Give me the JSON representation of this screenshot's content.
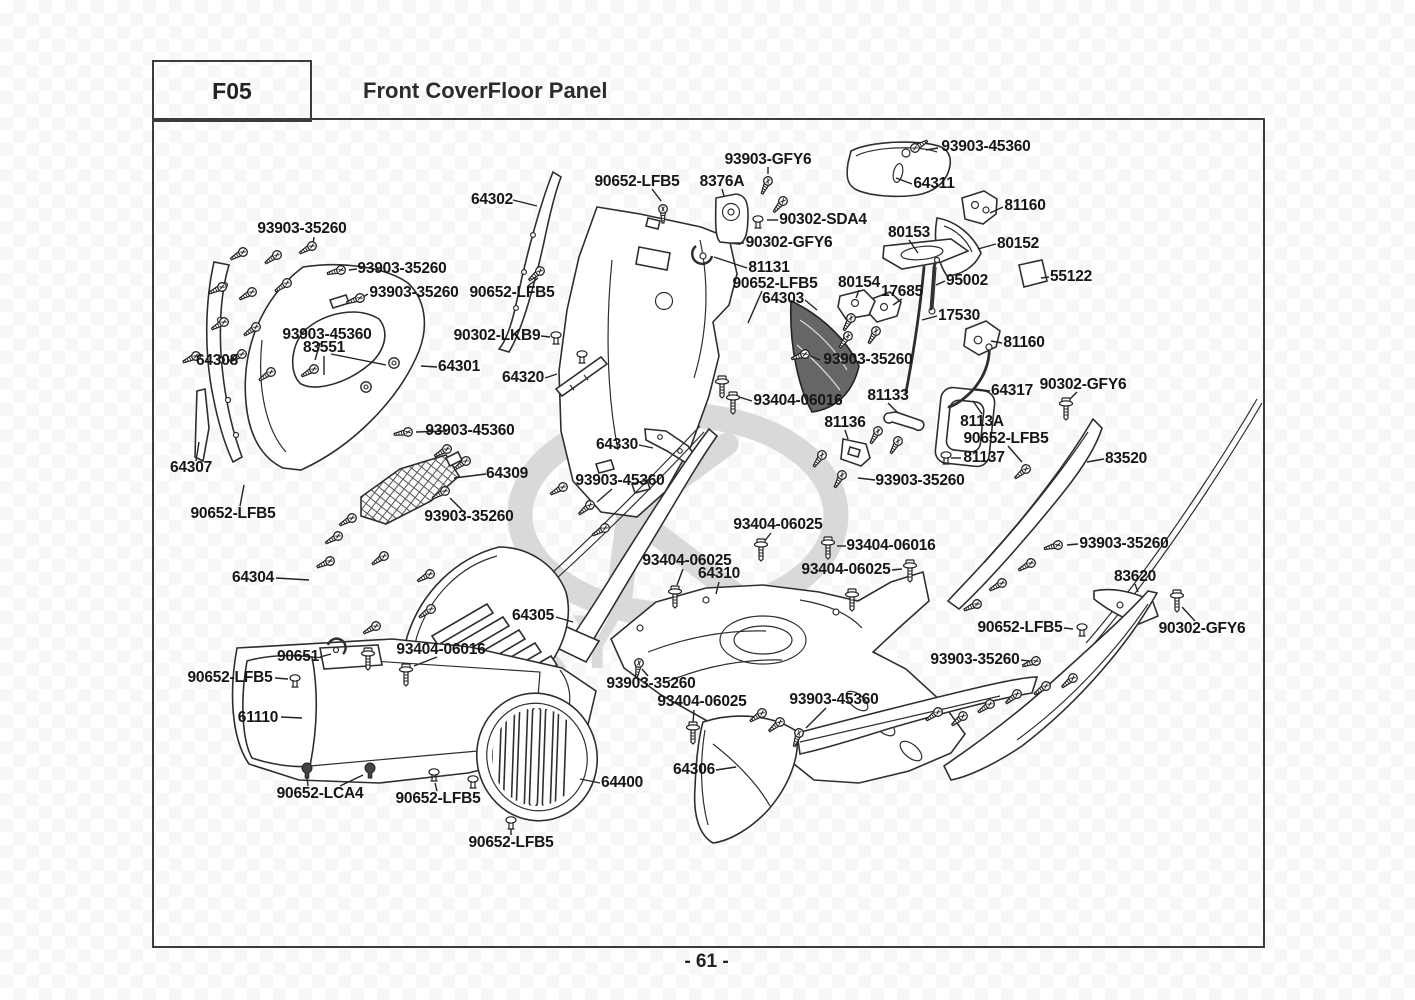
{
  "page": {
    "code": "F05",
    "title": "Front CoverFloor Panel",
    "page_number": "- 61 -",
    "watermark": "KYMCO"
  },
  "diagram": {
    "labels": [
      {
        "t": "93903-45360",
        "x": 986,
        "y": 147
      },
      {
        "t": "93903-GFY6",
        "x": 768,
        "y": 160
      },
      {
        "t": "90652-LFB5",
        "x": 637,
        "y": 182
      },
      {
        "t": "8376A",
        "x": 722,
        "y": 182
      },
      {
        "t": "64302",
        "x": 492,
        "y": 200
      },
      {
        "t": "64311",
        "x": 934,
        "y": 184
      },
      {
        "t": "81160",
        "x": 1025,
        "y": 206
      },
      {
        "t": "90302-SDA4",
        "x": 823,
        "y": 220
      },
      {
        "t": "80153",
        "x": 909,
        "y": 233
      },
      {
        "t": "93903-35260",
        "x": 302,
        "y": 229
      },
      {
        "t": "90302-GFY6",
        "x": 789,
        "y": 243
      },
      {
        "t": "80152",
        "x": 1018,
        "y": 244
      },
      {
        "t": "93903-35260",
        "x": 402,
        "y": 269
      },
      {
        "t": "81131",
        "x": 769,
        "y": 268
      },
      {
        "t": "55122",
        "x": 1071,
        "y": 277
      },
      {
        "t": "95002",
        "x": 967,
        "y": 281
      },
      {
        "t": "90652-LFB5",
        "x": 775,
        "y": 284
      },
      {
        "t": "80154",
        "x": 859,
        "y": 283
      },
      {
        "t": "17685",
        "x": 902,
        "y": 292
      },
      {
        "t": "93903-35260",
        "x": 414,
        "y": 293
      },
      {
        "t": "90652-LFB5",
        "x": 512,
        "y": 293
      },
      {
        "t": "64303",
        "x": 783,
        "y": 299
      },
      {
        "t": "17530",
        "x": 959,
        "y": 316
      },
      {
        "t": "93903-45360",
        "x": 327,
        "y": 335
      },
      {
        "t": "90302-LKB9",
        "x": 497,
        "y": 336
      },
      {
        "t": "83551",
        "x": 324,
        "y": 348
      },
      {
        "t": "93903-35260",
        "x": 868,
        "y": 360
      },
      {
        "t": "64308",
        "x": 217,
        "y": 361
      },
      {
        "t": "64301",
        "x": 459,
        "y": 367
      },
      {
        "t": "64320",
        "x": 523,
        "y": 378
      },
      {
        "t": "81160",
        "x": 1024,
        "y": 343
      },
      {
        "t": "90302-GFY6",
        "x": 1083,
        "y": 385
      },
      {
        "t": "64317",
        "x": 1012,
        "y": 391
      },
      {
        "t": "93404-06016",
        "x": 798,
        "y": 401
      },
      {
        "t": "81133",
        "x": 888,
        "y": 396
      },
      {
        "t": "8113A",
        "x": 982,
        "y": 422
      },
      {
        "t": "81136",
        "x": 845,
        "y": 423
      },
      {
        "t": "93903-45360",
        "x": 470,
        "y": 431
      },
      {
        "t": "90652-LFB5",
        "x": 1006,
        "y": 439
      },
      {
        "t": "64330",
        "x": 617,
        "y": 445
      },
      {
        "t": "81137",
        "x": 984,
        "y": 458
      },
      {
        "t": "83520",
        "x": 1126,
        "y": 459
      },
      {
        "t": "64307",
        "x": 191,
        "y": 468
      },
      {
        "t": "64309",
        "x": 507,
        "y": 474
      },
      {
        "t": "93903-45360",
        "x": 620,
        "y": 481
      },
      {
        "t": "93903-35260",
        "x": 920,
        "y": 481
      },
      {
        "t": "90652-LFB5",
        "x": 233,
        "y": 514
      },
      {
        "t": "93903-35260",
        "x": 469,
        "y": 517
      },
      {
        "t": "93404-06025",
        "x": 778,
        "y": 525
      },
      {
        "t": "93903-35260",
        "x": 1124,
        "y": 544
      },
      {
        "t": "93404-06016",
        "x": 891,
        "y": 546
      },
      {
        "t": "93404-06025",
        "x": 687,
        "y": 561
      },
      {
        "t": "93404-06025",
        "x": 846,
        "y": 570
      },
      {
        "t": "64310",
        "x": 719,
        "y": 574
      },
      {
        "t": "83620",
        "x": 1135,
        "y": 577
      },
      {
        "t": "64304",
        "x": 253,
        "y": 578
      },
      {
        "t": "64305",
        "x": 533,
        "y": 616
      },
      {
        "t": "90651",
        "x": 298,
        "y": 657
      },
      {
        "t": "93404-06016",
        "x": 441,
        "y": 650
      },
      {
        "t": "93903-35260",
        "x": 975,
        "y": 660
      },
      {
        "t": "90652-LFB5",
        "x": 1020,
        "y": 628
      },
      {
        "t": "90302-GFY6",
        "x": 1202,
        "y": 629
      },
      {
        "t": "90652-LFB5",
        "x": 230,
        "y": 678
      },
      {
        "t": "93903-35260",
        "x": 651,
        "y": 684
      },
      {
        "t": "93404-06025",
        "x": 702,
        "y": 702
      },
      {
        "t": "93903-45360",
        "x": 834,
        "y": 700
      },
      {
        "t": "61110",
        "x": 258,
        "y": 718
      },
      {
        "t": "64306",
        "x": 694,
        "y": 770
      },
      {
        "t": "64400",
        "x": 622,
        "y": 783
      },
      {
        "t": "90652-LCA4",
        "x": 320,
        "y": 794
      },
      {
        "t": "90652-LFB5",
        "x": 438,
        "y": 799
      },
      {
        "t": "90652-LFB5",
        "x": 511,
        "y": 843
      }
    ],
    "fasteners": [
      {
        "k": "s",
        "x": 915,
        "y": 148,
        "r": -30
      },
      {
        "k": "s",
        "x": 768,
        "y": 181,
        "r": 115
      },
      {
        "k": "s",
        "x": 783,
        "y": 201,
        "r": 130
      },
      {
        "k": "s",
        "x": 663,
        "y": 209,
        "r": 90
      },
      {
        "k": "s",
        "x": 243,
        "y": 252,
        "r": 150
      },
      {
        "k": "s",
        "x": 277,
        "y": 255,
        "r": 145
      },
      {
        "k": "s",
        "x": 312,
        "y": 246,
        "r": 150
      },
      {
        "k": "s",
        "x": 222,
        "y": 287,
        "r": 155
      },
      {
        "k": "s",
        "x": 252,
        "y": 292,
        "r": 150
      },
      {
        "k": "s",
        "x": 287,
        "y": 283,
        "r": 145
      },
      {
        "k": "s",
        "x": 224,
        "y": 322,
        "r": 150
      },
      {
        "k": "s",
        "x": 256,
        "y": 327,
        "r": 145
      },
      {
        "k": "s",
        "x": 196,
        "y": 356,
        "r": 155
      },
      {
        "k": "s",
        "x": 242,
        "y": 354,
        "r": 150
      },
      {
        "k": "s",
        "x": 271,
        "y": 372,
        "r": 145
      },
      {
        "k": "s",
        "x": 314,
        "y": 369,
        "r": 150
      },
      {
        "k": "s",
        "x": 341,
        "y": 270,
        "r": 165
      },
      {
        "k": "s",
        "x": 360,
        "y": 298,
        "r": 160
      },
      {
        "k": "s",
        "x": 540,
        "y": 271,
        "r": 140
      },
      {
        "k": "s",
        "x": 408,
        "y": 432,
        "r": 170
      },
      {
        "k": "s",
        "x": 805,
        "y": 354,
        "r": 160
      },
      {
        "k": "s",
        "x": 851,
        "y": 318,
        "r": 120
      },
      {
        "k": "s",
        "x": 848,
        "y": 336,
        "r": 125
      },
      {
        "k": "s",
        "x": 876,
        "y": 331,
        "r": 120
      },
      {
        "k": "s",
        "x": 447,
        "y": 449,
        "r": 150
      },
      {
        "k": "s",
        "x": 466,
        "y": 461,
        "r": 145
      },
      {
        "k": "s",
        "x": 445,
        "y": 491,
        "r": 150
      },
      {
        "k": "s",
        "x": 563,
        "y": 487,
        "r": 150
      },
      {
        "k": "s",
        "x": 605,
        "y": 528,
        "r": 150
      },
      {
        "k": "s",
        "x": 590,
        "y": 505,
        "r": 140
      },
      {
        "k": "s",
        "x": 352,
        "y": 518,
        "r": 150
      },
      {
        "k": "s",
        "x": 338,
        "y": 536,
        "r": 150
      },
      {
        "k": "s",
        "x": 330,
        "y": 561,
        "r": 155
      },
      {
        "k": "s",
        "x": 384,
        "y": 556,
        "r": 145
      },
      {
        "k": "s",
        "x": 430,
        "y": 574,
        "r": 150
      },
      {
        "k": "s",
        "x": 431,
        "y": 609,
        "r": 145
      },
      {
        "k": "s",
        "x": 376,
        "y": 626,
        "r": 150
      },
      {
        "k": "s",
        "x": 878,
        "y": 431,
        "r": 120
      },
      {
        "k": "s",
        "x": 898,
        "y": 441,
        "r": 120
      },
      {
        "k": "s",
        "x": 822,
        "y": 455,
        "r": 125
      },
      {
        "k": "s",
        "x": 842,
        "y": 475,
        "r": 120
      },
      {
        "k": "s",
        "x": 1026,
        "y": 469,
        "r": 140
      },
      {
        "k": "s",
        "x": 1058,
        "y": 545,
        "r": 165
      },
      {
        "k": "s",
        "x": 1031,
        "y": 563,
        "r": 150
      },
      {
        "k": "s",
        "x": 1002,
        "y": 583,
        "r": 150
      },
      {
        "k": "s",
        "x": 977,
        "y": 604,
        "r": 155
      },
      {
        "k": "s",
        "x": 1036,
        "y": 661,
        "r": 160
      },
      {
        "k": "s",
        "x": 938,
        "y": 712,
        "r": 145
      },
      {
        "k": "s",
        "x": 963,
        "y": 716,
        "r": 140
      },
      {
        "k": "s",
        "x": 990,
        "y": 704,
        "r": 145
      },
      {
        "k": "s",
        "x": 1017,
        "y": 694,
        "r": 140
      },
      {
        "k": "s",
        "x": 1046,
        "y": 686,
        "r": 145
      },
      {
        "k": "s",
        "x": 1073,
        "y": 678,
        "r": 140
      },
      {
        "k": "s",
        "x": 639,
        "y": 663,
        "r": 100
      },
      {
        "k": "s",
        "x": 762,
        "y": 713,
        "r": 145
      },
      {
        "k": "s",
        "x": 780,
        "y": 722,
        "r": 140
      },
      {
        "k": "s",
        "x": 799,
        "y": 733,
        "r": 110
      },
      {
        "k": "b",
        "x": 722,
        "y": 385
      },
      {
        "k": "b",
        "x": 733,
        "y": 401
      },
      {
        "k": "b",
        "x": 761,
        "y": 548
      },
      {
        "k": "b",
        "x": 828,
        "y": 546
      },
      {
        "k": "b",
        "x": 910,
        "y": 569
      },
      {
        "k": "b",
        "x": 675,
        "y": 595
      },
      {
        "k": "b",
        "x": 693,
        "y": 731
      },
      {
        "k": "b",
        "x": 1066,
        "y": 407
      },
      {
        "k": "b",
        "x": 1177,
        "y": 599
      },
      {
        "k": "b",
        "x": 368,
        "y": 657
      },
      {
        "k": "b",
        "x": 406,
        "y": 673
      },
      {
        "k": "b",
        "x": 852,
        "y": 598
      },
      {
        "k": "c",
        "x": 295,
        "y": 680
      },
      {
        "k": "c",
        "x": 434,
        "y": 774
      },
      {
        "k": "c",
        "x": 473,
        "y": 781
      },
      {
        "k": "c",
        "x": 511,
        "y": 822
      },
      {
        "k": "c",
        "x": 946,
        "y": 457
      },
      {
        "k": "c",
        "x": 1082,
        "y": 629
      },
      {
        "k": "c",
        "x": 758,
        "y": 221
      },
      {
        "k": "c",
        "x": 556,
        "y": 337
      },
      {
        "k": "c",
        "x": 582,
        "y": 356
      },
      {
        "k": "r",
        "x": 307,
        "y": 768
      },
      {
        "k": "r",
        "x": 370,
        "y": 768
      },
      {
        "k": "g",
        "x": 366,
        "y": 387
      },
      {
        "k": "g",
        "x": 394,
        "y": 363
      }
    ],
    "leaders": [
      [
        938,
        148,
        926,
        150
      ],
      [
        768,
        167,
        768,
        174
      ],
      [
        722,
        189,
        724,
        196
      ],
      [
        652,
        189,
        661,
        201
      ],
      [
        513,
        200,
        537,
        206
      ],
      [
        912,
        184,
        896,
        178
      ],
      [
        1003,
        207,
        990,
        213
      ],
      [
        778,
        220,
        767,
        220
      ],
      [
        909,
        240,
        918,
        253
      ],
      [
        314,
        237,
        313,
        245
      ],
      [
        744,
        243,
        732,
        243
      ],
      [
        996,
        244,
        978,
        249
      ],
      [
        357,
        269,
        349,
        270
      ],
      [
        747,
        268,
        714,
        257
      ],
      [
        1049,
        277,
        1041,
        278
      ],
      [
        945,
        281,
        936,
        285
      ],
      [
        762,
        291,
        748,
        323
      ],
      [
        859,
        290,
        856,
        298
      ],
      [
        902,
        299,
        893,
        305
      ],
      [
        368,
        294,
        363,
        297
      ],
      [
        528,
        286,
        538,
        278
      ],
      [
        805,
        300,
        817,
        310
      ],
      [
        937,
        316,
        922,
        320
      ],
      [
        320,
        343,
        315,
        360
      ],
      [
        541,
        336,
        550,
        337
      ],
      [
        324,
        356,
        324,
        375
      ],
      [
        331,
        354,
        386,
        365
      ],
      [
        820,
        360,
        810,
        356
      ],
      [
        437,
        367,
        421,
        366
      ],
      [
        545,
        378,
        557,
        374
      ],
      [
        1002,
        343,
        991,
        341
      ],
      [
        1077,
        392,
        1068,
        401
      ],
      [
        990,
        391,
        975,
        389
      ],
      [
        752,
        401,
        739,
        397
      ],
      [
        888,
        403,
        898,
        413
      ],
      [
        982,
        414,
        973,
        401
      ],
      [
        845,
        430,
        848,
        439
      ],
      [
        447,
        431,
        416,
        432
      ],
      [
        1008,
        446,
        1022,
        462
      ],
      [
        961,
        458,
        951,
        458
      ],
      [
        1104,
        459,
        1087,
        462
      ],
      [
        486,
        474,
        454,
        478
      ],
      [
        639,
        445,
        653,
        448
      ],
      [
        612,
        489,
        597,
        502
      ],
      [
        196,
        461,
        199,
        442
      ],
      [
        462,
        510,
        450,
        498
      ],
      [
        240,
        506,
        244,
        485
      ],
      [
        276,
        578,
        309,
        580
      ],
      [
        556,
        617,
        573,
        622
      ],
      [
        719,
        582,
        716,
        594
      ],
      [
        771,
        533,
        763,
        543
      ],
      [
        846,
        546,
        837,
        546
      ],
      [
        892,
        570,
        902,
        569
      ],
      [
        683,
        569,
        677,
        585
      ],
      [
        1078,
        544,
        1067,
        545
      ],
      [
        1135,
        584,
        1138,
        592
      ],
      [
        1195,
        621,
        1182,
        607
      ],
      [
        1064,
        628,
        1073,
        629
      ],
      [
        1021,
        660,
        1029,
        661
      ],
      [
        648,
        676,
        642,
        669
      ],
      [
        694,
        710,
        693,
        723
      ],
      [
        826,
        708,
        806,
        728
      ],
      [
        716,
        770,
        736,
        767
      ],
      [
        600,
        783,
        580,
        779
      ],
      [
        281,
        717,
        302,
        718
      ],
      [
        320,
        657,
        331,
        654
      ],
      [
        437,
        657,
        414,
        666
      ],
      [
        275,
        678,
        288,
        679
      ],
      [
        308,
        786,
        307,
        777
      ],
      [
        340,
        786,
        363,
        775
      ],
      [
        437,
        791,
        435,
        783
      ],
      [
        511,
        835,
        511,
        829
      ],
      [
        875,
        480,
        858,
        478
      ]
    ]
  }
}
